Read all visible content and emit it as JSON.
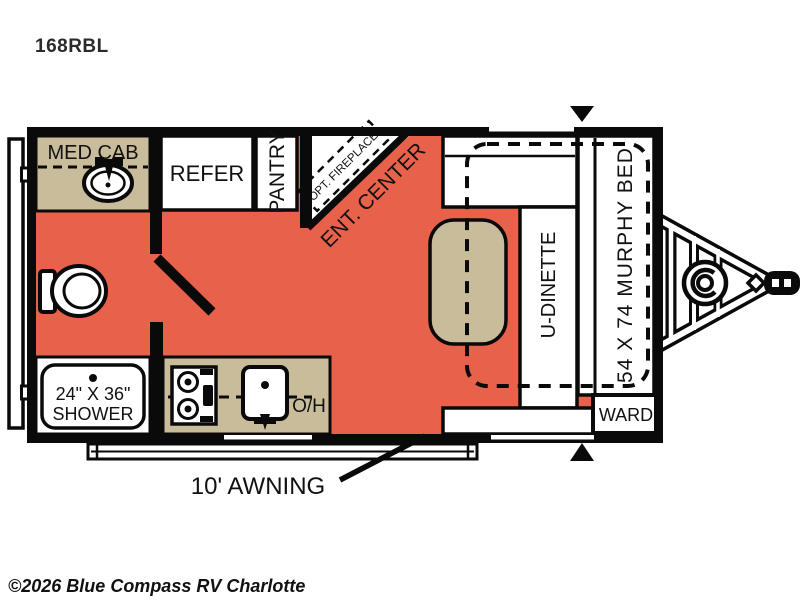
{
  "title": "168RBL",
  "watermark": "©2026 Blue Compass RV Charlotte",
  "colors": {
    "floor": "#E8614B",
    "cabinet": "#C9BC9B",
    "wall": "#0A0A0A",
    "watermark": "#ABABAB"
  },
  "labels": {
    "med_cab": "MED CAB",
    "refer": "REFER",
    "pantry": "PANTRY",
    "opt_fireplace": "OPT. FIREPLACE",
    "ent_center": "ENT. CENTER",
    "u_dinette": "U-DINETTE",
    "murphy_bed": "54 X 74 MURPHY BED",
    "ward": "WARD",
    "shower_size": "24\" X 36\"",
    "shower": "SHOWER",
    "overhead": "O/H",
    "awning": "10' AWNING"
  }
}
